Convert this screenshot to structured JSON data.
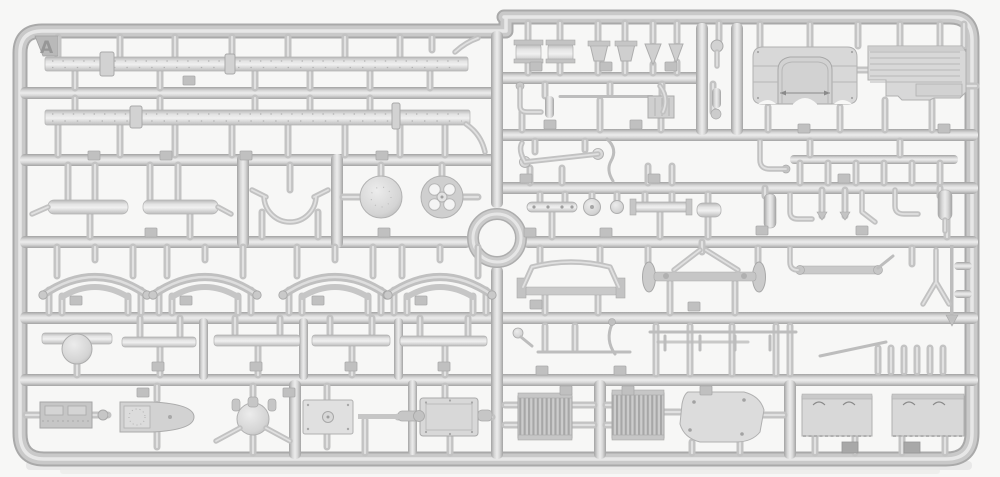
{
  "image": {
    "type": "photograph",
    "subject": "light-grey injection-molded plastic model kit sprue (parts frame) on white background",
    "sprue_letter": "A"
  },
  "colors": {
    "background": "#f7f7f6",
    "plastic_base": "#c7c7c7",
    "plastic_shadow": "#a6a6a6",
    "plastic_highlight": "#e7e7e7",
    "part_panel": "#d8d8d8",
    "radiator_fin": "#a9a9a9",
    "cast_shadow": "#dcdcdc"
  },
  "part_groups": [
    "chassis-rail",
    "muffler",
    "steering-wheel-arc",
    "brake-drum",
    "spare-wheel-disc",
    "leaf-spring",
    "differential-housing",
    "axle-bar",
    "engine-block",
    "gearbox",
    "axle-housing",
    "mounting-plate",
    "transfer-case",
    "pulley-drum",
    "filter-cup",
    "funnel",
    "cab-rear-panel",
    "cab-floor-panel",
    "drag-link",
    "exhaust-elbow",
    "linkage-rod",
    "front-axle",
    "cross-member",
    "radiator",
    "fuel-tank",
    "stowage-box-panel"
  ]
}
